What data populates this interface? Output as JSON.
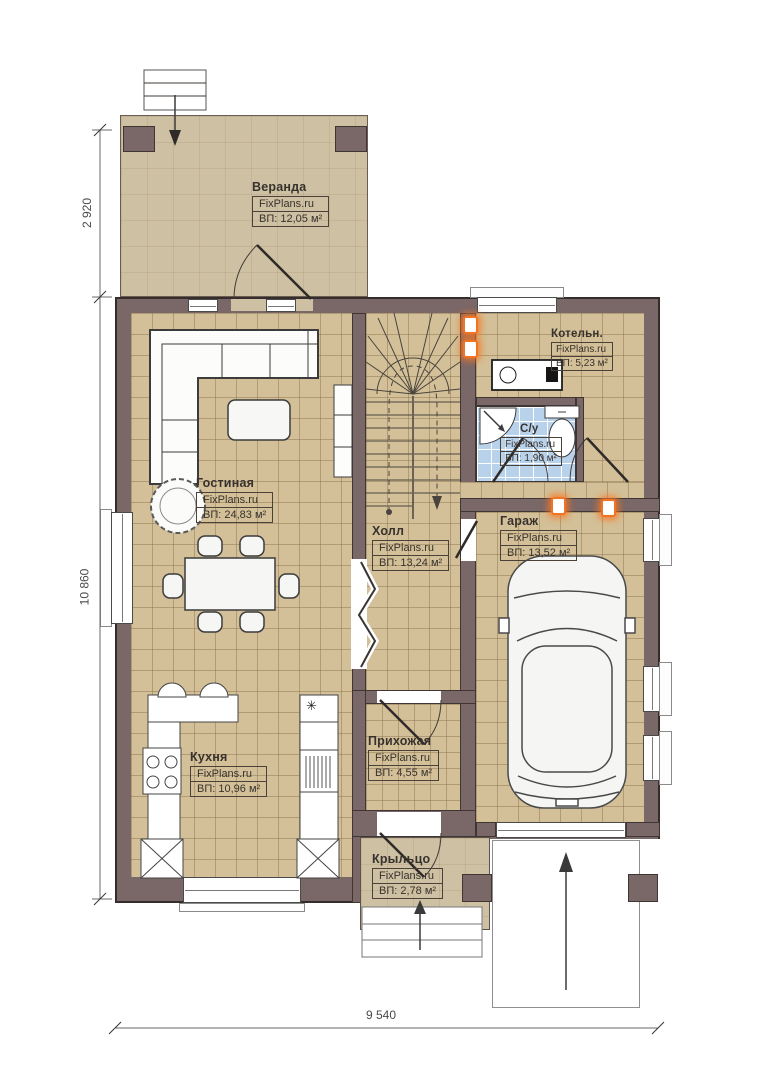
{
  "plan": {
    "dimensions": {
      "vertical_top": "2 920",
      "vertical_main": "10 860",
      "horizontal_bottom": "9 540"
    },
    "rooms": [
      {
        "id": "veranda",
        "name": "Веранда",
        "brand": "FixPlans.ru",
        "area": "ВП: 12,05 м²"
      },
      {
        "id": "gostinaya",
        "name": "Гостиная",
        "brand": "FixPlans.ru",
        "area": "ВП: 24,83 м²"
      },
      {
        "id": "holl",
        "name": "Холл",
        "brand": "FixPlans.ru",
        "area": "ВП: 13,24 м²"
      },
      {
        "id": "kotelnaya",
        "name": "Котельн.",
        "brand": "FixPlans.ru",
        "area": "ВП: 5,23 м²"
      },
      {
        "id": "sanuzel",
        "name": "С/у",
        "brand": "FixPlans.ru",
        "area": "ВП: 1,90 м²"
      },
      {
        "id": "garazh",
        "name": "Гараж",
        "brand": "FixPlans.ru",
        "area": "ВП: 13,52 м²"
      },
      {
        "id": "kuhnya",
        "name": "Кухня",
        "brand": "FixPlans.ru",
        "area": "ВП: 10,96 м²"
      },
      {
        "id": "prihozhaya",
        "name": "Прихожая",
        "brand": "FixPlans.ru",
        "area": "ВП: 4,55 м²"
      },
      {
        "id": "kryltso",
        "name": "Крыльцо",
        "brand": "FixPlans.ru",
        "area": "ВП: 2,78 м²"
      }
    ],
    "icons": {
      "kitchen_appliance_star": "✳"
    },
    "colors": {
      "wall": "#7a6767",
      "floor_tile": "#d3c098",
      "veranda": "#cec0a2",
      "bathroom_tile": "#b9d2ec",
      "vent_marker": "#f07423"
    }
  }
}
